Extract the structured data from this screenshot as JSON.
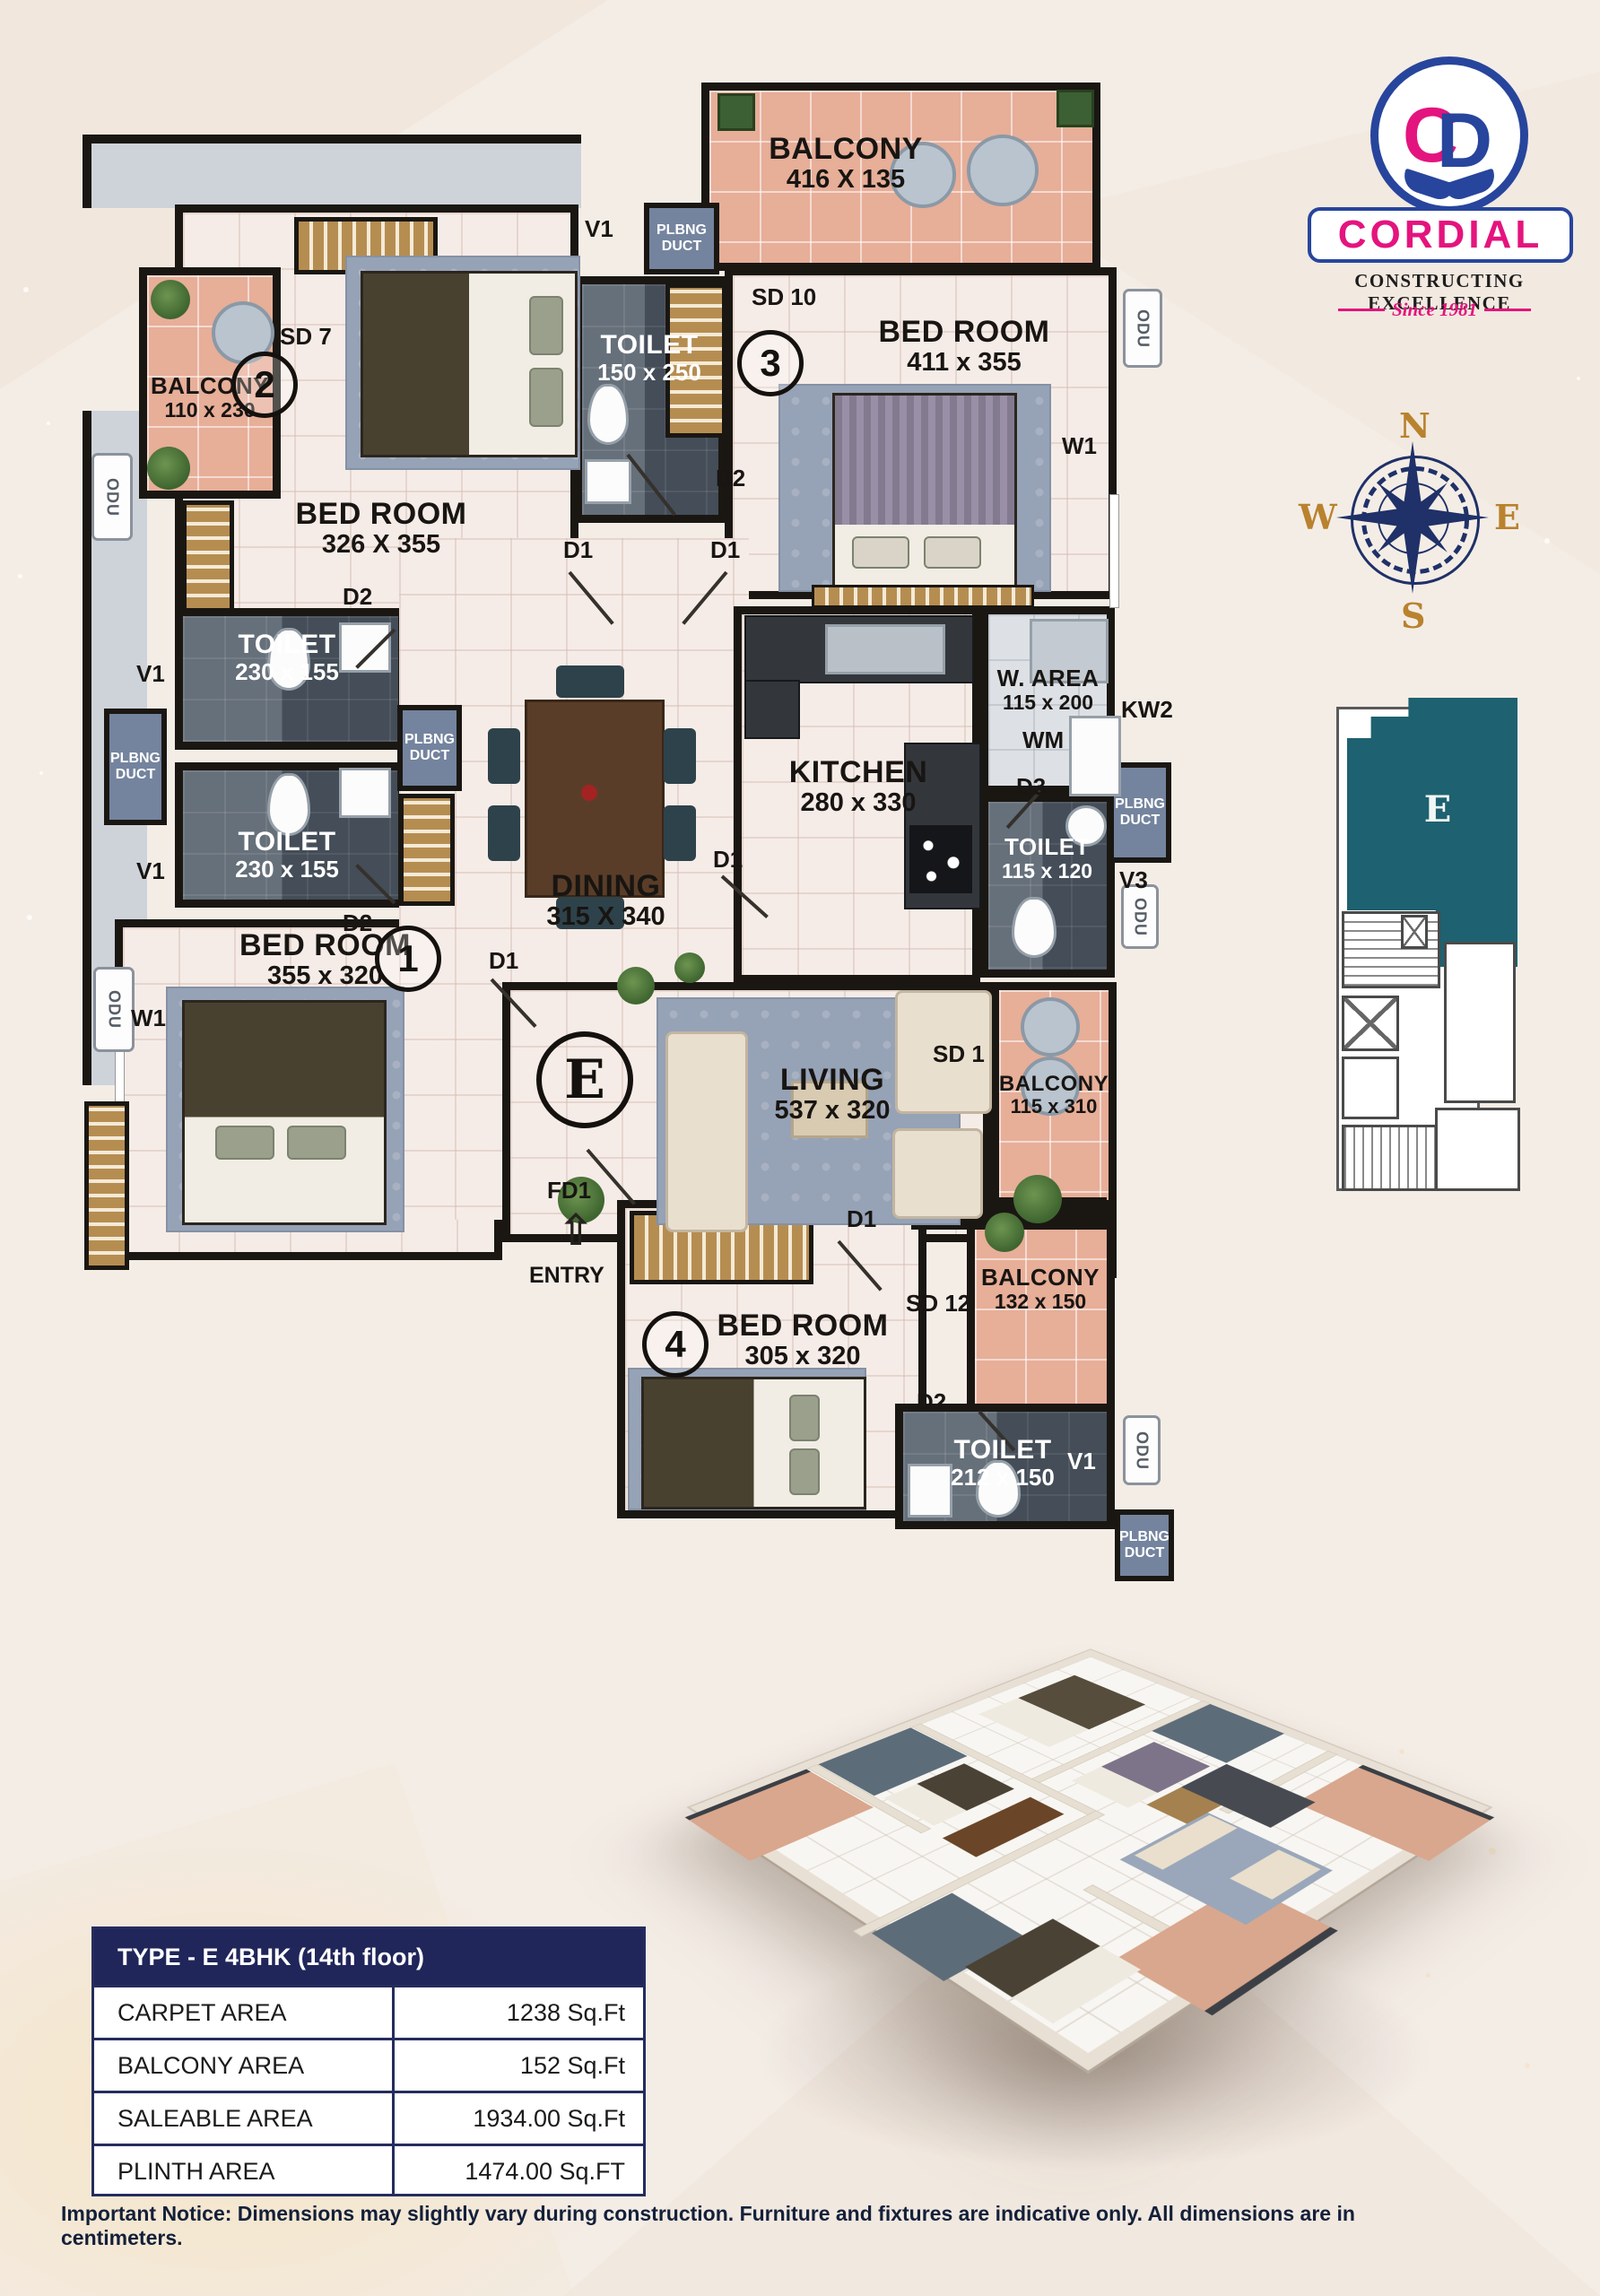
{
  "colors": {
    "pink": "#e4147e",
    "blue": "#27459c",
    "navy": "#20265a",
    "teal": "#1e6170",
    "gold": "#b9822e"
  },
  "brand": {
    "name": "CORDIAL",
    "tagline": "CONSTRUCTING EXCELLENCE",
    "since": "Since 1981",
    "monogram_c": "C",
    "monogram_d": "D"
  },
  "compass": {
    "n": "N",
    "e": "E",
    "s": "S",
    "w": "W"
  },
  "key_plan": {
    "unit": "E"
  },
  "floor_plan": {
    "unit_circle": "E",
    "entry": "ENTRY",
    "tv": "TV",
    "odu": "ODU",
    "wm": "WM",
    "duct1": "PLBNG",
    "duct2": "DUCT",
    "marks": {
      "v1": "V1",
      "v3": "V3",
      "w1": "W1",
      "kw2": "KW2",
      "d1": "D1",
      "d2": "D2",
      "d3": "D3",
      "fd1": "FD1",
      "sd1": "SD 1",
      "sd7": "SD 7",
      "sd10": "SD 10",
      "sd12": "SD 12"
    },
    "rooms": {
      "bedroom1": {
        "name": "BED ROOM",
        "dims": "355 x 320",
        "num": "1"
      },
      "bedroom2": {
        "name": "BED ROOM",
        "dims": "326 X 355",
        "num": "2"
      },
      "bedroom3": {
        "name": "BED ROOM",
        "dims": "411 x 355",
        "num": "3"
      },
      "bedroom4": {
        "name": "BED ROOM",
        "dims": "305 x 320",
        "num": "4"
      },
      "balcony_top": {
        "name": "BALCONY",
        "dims": "416 X 135"
      },
      "balcony_tl": {
        "name": "BALCONY",
        "dims": "110 x 230"
      },
      "balcony_right": {
        "name": "BALCONY",
        "dims": "115 x 310"
      },
      "balcony_br": {
        "name": "BALCONY",
        "dims": "132 x 150"
      },
      "toilet_top": {
        "name": "TOILET",
        "dims": "150 x 250"
      },
      "toilet_a": {
        "name": "TOILET",
        "dims": "230 x 155"
      },
      "toilet_b": {
        "name": "TOILET",
        "dims": "230 x 155"
      },
      "toilet_mid": {
        "name": "TOILET",
        "dims": "115 x 120"
      },
      "toilet_4": {
        "name": "TOILET",
        "dims": "212 x 150"
      },
      "dining": {
        "name": "DINING",
        "dims": "315 X 340"
      },
      "kitchen": {
        "name": "KITCHEN",
        "dims": "280 x 330"
      },
      "living": {
        "name": "LIVING",
        "dims": "537 x 320"
      },
      "w_area": {
        "name": "W. AREA",
        "dims": "115 x 200"
      }
    }
  },
  "area_table": {
    "title": "TYPE - E 4BHK (14th floor)",
    "rows": [
      {
        "label": "CARPET AREA",
        "value": "1238 Sq.Ft"
      },
      {
        "label": "BALCONY AREA",
        "value": "152 Sq.Ft"
      },
      {
        "label": "SALEABLE AREA",
        "value": "1934.00 Sq.Ft"
      },
      {
        "label": "PLINTH AREA",
        "value": "1474.00 Sq.FT"
      }
    ]
  },
  "notice": "Important Notice: Dimensions may slightly vary during construction. Furniture and fixtures are indicative only. All dimensions are in centimeters."
}
